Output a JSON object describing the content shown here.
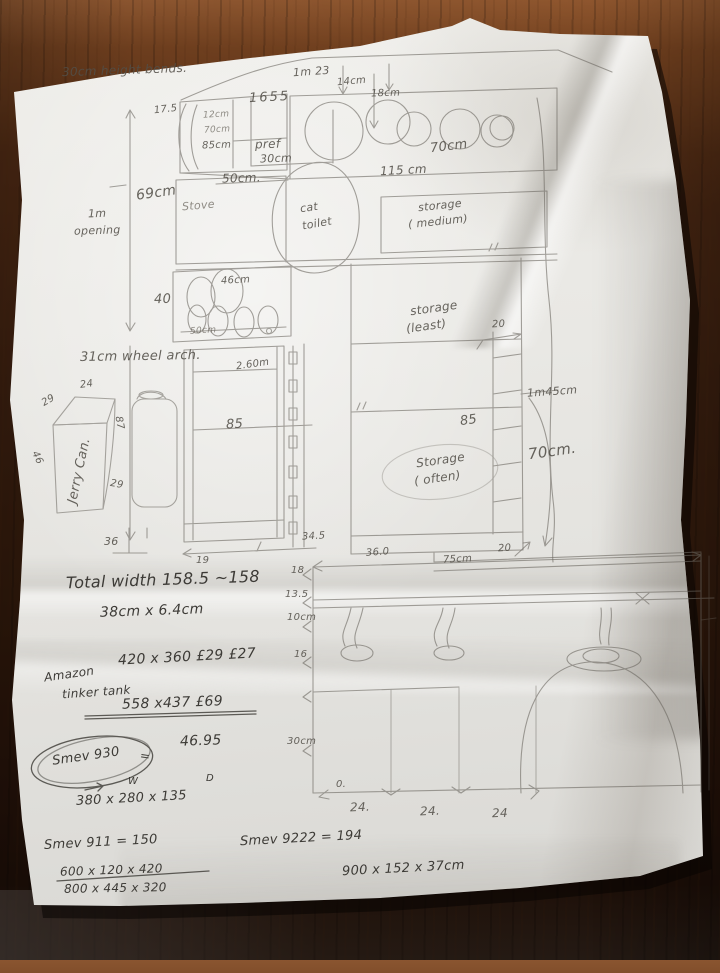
{
  "palette": {
    "paper": "#e9e8e4",
    "pencil": "#6b6760",
    "graphite": "#3f3d38",
    "wood": "#4a2a15"
  },
  "top": {
    "height_bends": "30cm height bends.",
    "d_1m23": "1m 23",
    "d_14cm": "14cm",
    "d_18cm": "18cm",
    "d_1655": "1655",
    "d_125": "17.5",
    "d_12cm": "12cm",
    "d_70cm": "70cm",
    "d_85cm": "85cm",
    "pref_1": "pref",
    "pref_2": "30cm",
    "d_50cm": "50cm.",
    "d_69cm": "69cm",
    "opening_1": "1m",
    "opening_2": "opening",
    "hob_70cm": "70cm",
    "d_115cm": "115 cm"
  },
  "middle": {
    "stove": "Stove",
    "cat_1": "cat",
    "cat_2": "toilet",
    "storage_medium_1": "storage",
    "storage_medium_2": "( medium)",
    "d_46cm": "46cm",
    "d_50cm": "50cm",
    "storage_least_1": "storage",
    "storage_least_2": "(least)",
    "d_260": "2.60m",
    "d_85": "85",
    "d_40": "40",
    "wheel_arch": "31cm wheel arch.",
    "d_345": "34.5",
    "d_19": "19"
  },
  "right": {
    "d_20": "20",
    "d_1m45": "1m45cm",
    "d_85": "85",
    "d_70cm": "70cm.",
    "storage_often_1": "Storage",
    "storage_often_2": "( often)"
  },
  "lower": {
    "d_360": "36.0",
    "d_75cm": "75cm",
    "d_20": "20",
    "d_18": "18",
    "d_135": "13.5",
    "d_10cm": "10cm",
    "d_16": "16",
    "d_30cm": "30cm",
    "o_mark": "0.",
    "d_24a": "24.",
    "d_24b": "24.",
    "d_24c": "24"
  },
  "jerry": {
    "d_24": "24",
    "d_29a": "29",
    "d_87": "87",
    "d_46": "46",
    "d_29b": "29",
    "label": "Jerry Can.",
    "d_36": "36"
  },
  "notes": {
    "total_width": "Total width 158.5 ~158",
    "size_38": "38cm x 6.4cm",
    "dims_420": "420 x 360 £29 £27",
    "amazon_1": "Amazon",
    "amazon_2": "tinker tank",
    "dims_558": "558 x437 £69",
    "smev_930": "Smev 930",
    "eq": "=",
    "price_930": "46.95",
    "w": "W",
    "d": "D",
    "dims_380": "380 x 280 x 135",
    "smev_911": "Smev 911 = 150",
    "dims_600": "600 x 120 x 420",
    "dims_800": "800 x 445 x 320",
    "smev_9222": "Smev 9222 = 194",
    "dims_900": "900 x 152 x 37cm"
  }
}
